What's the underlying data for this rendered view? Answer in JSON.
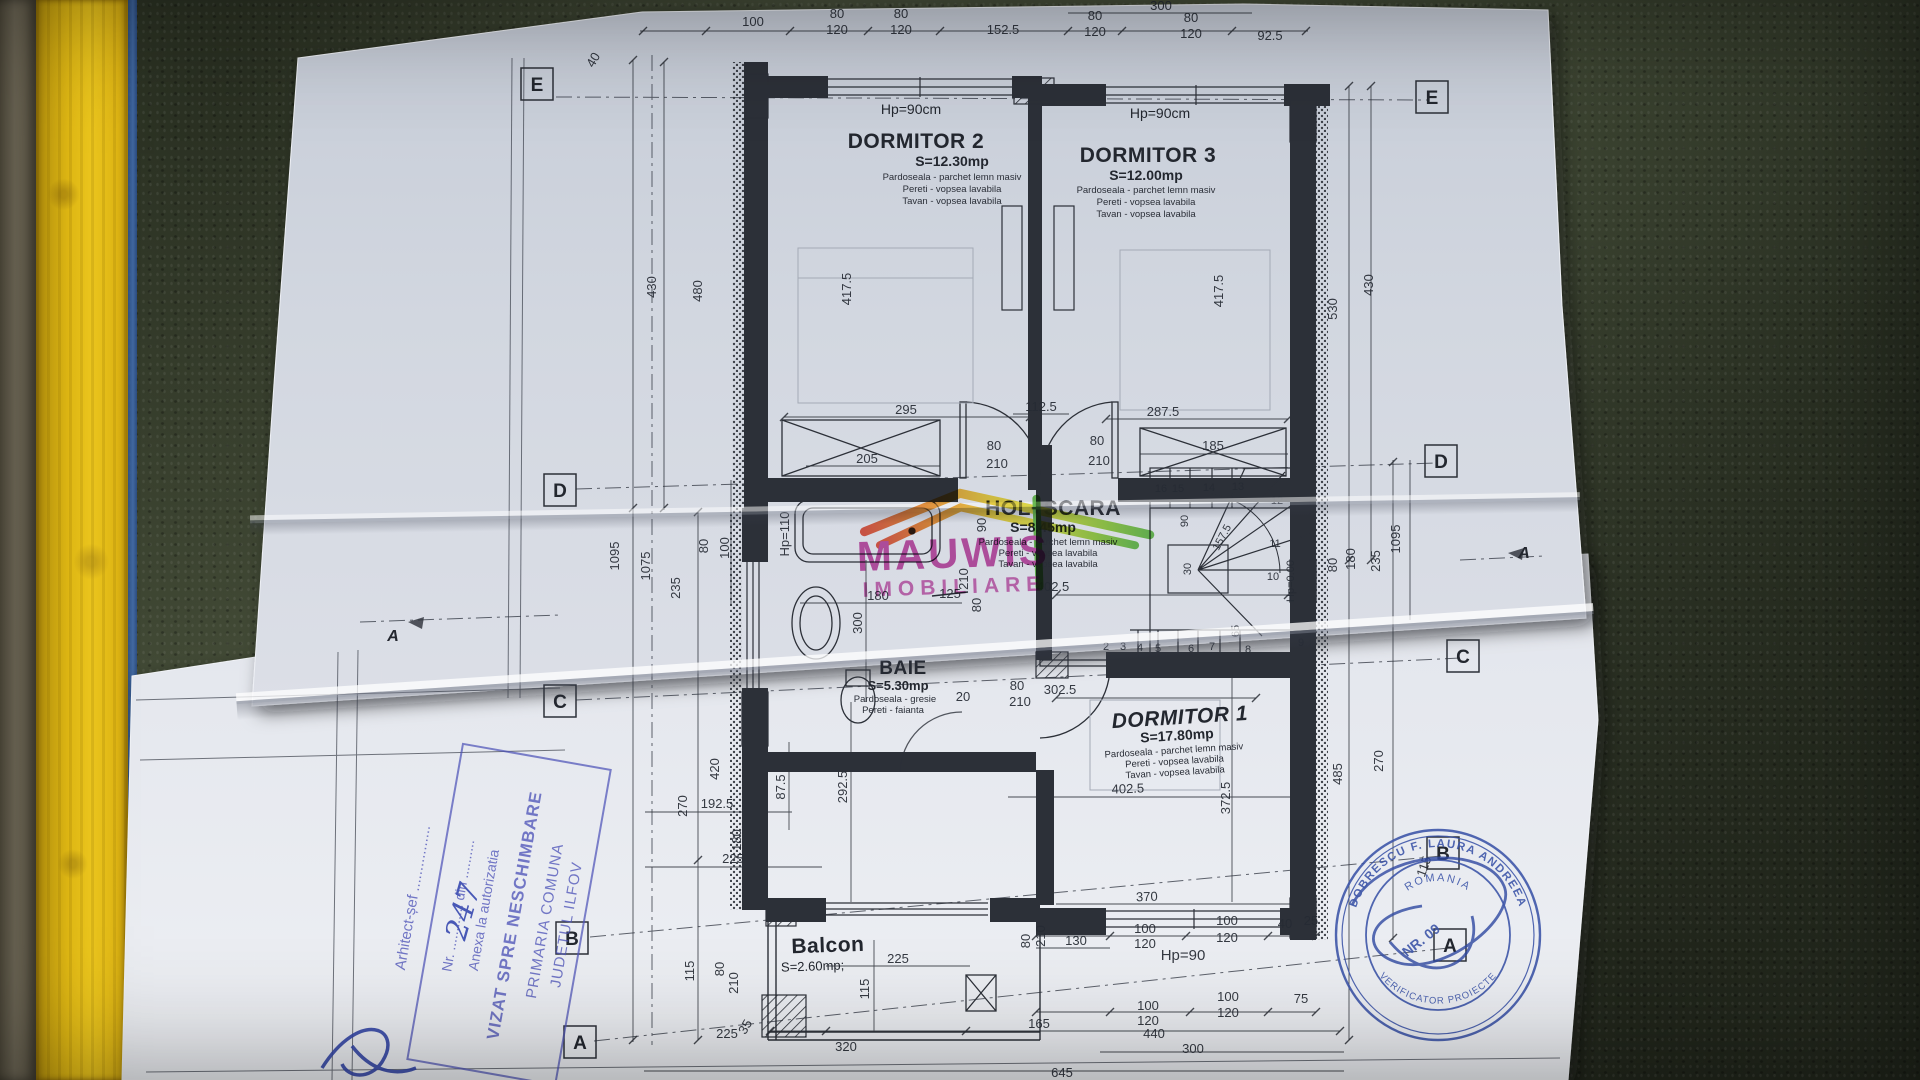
{
  "scene": {
    "background": "#47503a",
    "yellow_frame": "#ecc215",
    "paper": "#d3d8e1",
    "ink": "#262b34",
    "stamp_blue": "#4d53b8",
    "watermark_magenta": "#c23a9e"
  },
  "plan": {
    "hp": {
      "d2": "Hp=90cm",
      "d3": "Hp=90cm"
    },
    "rooms": {
      "d2": {
        "name": "DORMITOR 2",
        "area": "S=12.30mp",
        "m1": "Pardoseala - parchet lemn masiv",
        "m2": "Pereti - vopsea lavabila",
        "m3": "Tavan - vopsea lavabila"
      },
      "d3": {
        "name": "DORMITOR 3",
        "area": "S=12.00mp",
        "m1": "Pardoseala - parchet lemn masiv",
        "m2": "Pereti - vopsea lavabila",
        "m3": "Tavan - vopsea lavabila"
      },
      "hol": {
        "name": "HOL+SCARA",
        "area": "S=8.45mp",
        "m1": "Pardoseala - parchet lemn masiv",
        "m2": "Pereti - vopsea lavabila",
        "m3": "Tavan - vopsea lavabila"
      },
      "baie": {
        "name": "BAIE",
        "area": "S=5.30mp",
        "m1": "Pardoseala - gresie",
        "m2": "Pereti - faianta"
      },
      "d1": {
        "name": "DORMITOR 1",
        "area": "S=17.80mp",
        "m1": "Pardoseala - parchet lemn masiv",
        "m2": "Pereti - vopsea lavabila",
        "m3": "Tavan - vopsea lavabila"
      },
      "balcon": {
        "name": "Balcon",
        "area": "S=2.60mp;"
      }
    },
    "grid": [
      {
        "t": "E",
        "x": 537,
        "y": 84
      },
      {
        "t": "E",
        "x": 1432,
        "y": 97
      },
      {
        "t": "D",
        "x": 560,
        "y": 490
      },
      {
        "t": "D",
        "x": 1441,
        "y": 461
      },
      {
        "t": "C",
        "x": 560,
        "y": 701
      },
      {
        "t": "C",
        "x": 1463,
        "y": 656
      },
      {
        "t": "B",
        "x": 572,
        "y": 938
      },
      {
        "t": "B",
        "x": 1443,
        "y": 853
      },
      {
        "t": "A",
        "x": 580,
        "y": 1042
      },
      {
        "t": "A",
        "x": 1450,
        "y": 945
      },
      {
        "t": "A",
        "x": 393,
        "y": 634,
        "plain": true
      },
      {
        "t": "A",
        "x": 1524,
        "y": 551,
        "plain": true
      }
    ],
    "dims": [
      {
        "t": "100",
        "x": 753,
        "y": 26
      },
      {
        "t": "80",
        "x": 837,
        "y": 18
      },
      {
        "t": "120",
        "x": 837,
        "y": 34
      },
      {
        "t": "80",
        "x": 901,
        "y": 18
      },
      {
        "t": "120",
        "x": 901,
        "y": 34
      },
      {
        "t": "152.5",
        "x": 1003,
        "y": 34
      },
      {
        "t": "80",
        "x": 1095,
        "y": 20
      },
      {
        "t": "120",
        "x": 1095,
        "y": 36
      },
      {
        "t": "300",
        "x": 1161,
        "y": 10
      },
      {
        "t": "80",
        "x": 1191,
        "y": 22
      },
      {
        "t": "120",
        "x": 1191,
        "y": 38
      },
      {
        "t": "92.5",
        "x": 1270,
        "y": 40
      },
      {
        "t": "40",
        "x": 597,
        "y": 62,
        "r": -60
      },
      {
        "t": "430",
        "x": 656,
        "y": 287,
        "r": -90
      },
      {
        "t": "480",
        "x": 702,
        "y": 291,
        "r": -90
      },
      {
        "t": "417.5",
        "x": 851,
        "y": 289,
        "r": -90
      },
      {
        "t": "1095",
        "x": 619,
        "y": 556,
        "r": -90
      },
      {
        "t": "1075",
        "x": 650,
        "y": 566,
        "r": -90
      },
      {
        "t": "235",
        "x": 680,
        "y": 588,
        "r": -90
      },
      {
        "t": "80",
        "x": 708,
        "y": 546,
        "r": -90
      },
      {
        "t": "100",
        "x": 729,
        "y": 548,
        "r": -90
      },
      {
        "t": "Hp=110",
        "x": 789,
        "y": 534,
        "r": -90
      },
      {
        "t": "420",
        "x": 719,
        "y": 769,
        "r": -90
      },
      {
        "t": "270",
        "x": 687,
        "y": 806,
        "r": -90
      },
      {
        "t": "115",
        "x": 694,
        "y": 971,
        "r": -90
      },
      {
        "t": "80",
        "x": 724,
        "y": 969,
        "r": -90
      },
      {
        "t": "210",
        "x": 738,
        "y": 983,
        "r": -90
      },
      {
        "t": "35",
        "x": 749,
        "y": 1029,
        "r": -60
      },
      {
        "t": "300",
        "x": 862,
        "y": 623,
        "r": -90
      },
      {
        "t": "87.5",
        "x": 785,
        "y": 787,
        "r": -90
      },
      {
        "t": "292.5",
        "x": 847,
        "y": 787,
        "r": -90
      },
      {
        "t": "192.5",
        "x": 717,
        "y": 808
      },
      {
        "t": "180",
        "x": 741,
        "y": 840,
        "r": -90
      },
      {
        "t": "225",
        "x": 733,
        "y": 863
      },
      {
        "t": "530",
        "x": 1337,
        "y": 309,
        "r": -90
      },
      {
        "t": "430",
        "x": 1373,
        "y": 285,
        "r": -90
      },
      {
        "t": "417.5",
        "x": 1223,
        "y": 291,
        "r": -90
      },
      {
        "t": "1095",
        "x": 1400,
        "y": 539,
        "r": -90
      },
      {
        "t": "235",
        "x": 1380,
        "y": 561,
        "r": -90
      },
      {
        "t": "180",
        "x": 1355,
        "y": 559,
        "r": -90
      },
      {
        "t": "80",
        "x": 1337,
        "y": 565,
        "r": -90
      },
      {
        "t": "270",
        "x": 1383,
        "y": 761,
        "r": -90
      },
      {
        "t": "485",
        "x": 1342,
        "y": 774,
        "r": -90
      },
      {
        "t": "372.5",
        "x": 1230,
        "y": 798,
        "r": -90
      },
      {
        "t": "115",
        "x": 1428,
        "y": 868,
        "r": -70
      },
      {
        "t": "295",
        "x": 906,
        "y": 414
      },
      {
        "t": "287.5",
        "x": 1163,
        "y": 416
      },
      {
        "t": "205",
        "x": 867,
        "y": 463
      },
      {
        "t": "185",
        "x": 1213,
        "y": 450
      },
      {
        "t": "112.5",
        "x": 1041,
        "y": 411
      },
      {
        "t": "80",
        "x": 994,
        "y": 450
      },
      {
        "t": "210",
        "x": 997,
        "y": 468
      },
      {
        "t": "80",
        "x": 1097,
        "y": 445
      },
      {
        "t": "210",
        "x": 1099,
        "y": 465
      },
      {
        "t": "125",
        "x": 950,
        "y": 598,
        "strike": true
      },
      {
        "t": "90",
        "x": 986,
        "y": 525,
        "r": -90
      },
      {
        "t": "210",
        "x": 968,
        "y": 579,
        "r": -90
      },
      {
        "t": "80",
        "x": 981,
        "y": 605,
        "r": -90
      },
      {
        "t": "180",
        "x": 878,
        "y": 600
      },
      {
        "t": "402.5",
        "x": 1053,
        "y": 591
      },
      {
        "t": "302.5",
        "x": 1060,
        "y": 694
      },
      {
        "t": "20",
        "x": 963,
        "y": 701
      },
      {
        "t": "80",
        "x": 1017,
        "y": 690
      },
      {
        "t": "210",
        "x": 1020,
        "y": 706
      },
      {
        "t": "402.5",
        "x": 1128,
        "y": 793,
        "r": -2
      },
      {
        "t": "370",
        "x": 1147,
        "y": 901,
        "r": -2
      },
      {
        "t": "130",
        "x": 1076,
        "y": 945
      },
      {
        "t": "100",
        "x": 1145,
        "y": 933
      },
      {
        "t": "120",
        "x": 1145,
        "y": 948
      },
      {
        "t": "100",
        "x": 1227,
        "y": 925
      },
      {
        "t": "120",
        "x": 1227,
        "y": 942
      },
      {
        "t": "40",
        "x": 1285,
        "y": 928
      },
      {
        "t": "25",
        "x": 1311,
        "y": 925
      },
      {
        "t": "Hp=90",
        "x": 1183,
        "y": 960,
        "s": 15
      },
      {
        "t": "100",
        "x": 1148,
        "y": 1010
      },
      {
        "t": "120",
        "x": 1148,
        "y": 1025
      },
      {
        "t": "100",
        "x": 1228,
        "y": 1001
      },
      {
        "t": "120",
        "x": 1228,
        "y": 1017
      },
      {
        "t": "75",
        "x": 1301,
        "y": 1003
      },
      {
        "t": "165",
        "x": 1039,
        "y": 1028
      },
      {
        "t": "440",
        "x": 1154,
        "y": 1038
      },
      {
        "t": "300",
        "x": 1193,
        "y": 1053
      },
      {
        "t": "645",
        "x": 1062,
        "y": 1077
      },
      {
        "t": "80",
        "x": 1030,
        "y": 941,
        "r": -90
      },
      {
        "t": "210",
        "x": 1045,
        "y": 936,
        "r": -90
      },
      {
        "t": "225",
        "x": 898,
        "y": 963
      },
      {
        "t": "115",
        "x": 869,
        "y": 989,
        "r": -90
      },
      {
        "t": "225",
        "x": 727,
        "y": 1038
      },
      {
        "t": "320",
        "x": 846,
        "y": 1051
      },
      {
        "t": "90",
        "x": 1188,
        "y": 521,
        "r": -90,
        "s": 11
      },
      {
        "t": "30",
        "x": 1191,
        "y": 569,
        "r": -90,
        "s": 11
      },
      {
        "t": "157.5",
        "x": 1225,
        "y": 539,
        "r": -62,
        "s": 11
      },
      {
        "t": "65",
        "x": 1239,
        "y": 631,
        "r": -90,
        "s": 11
      },
      {
        "t": "Hp=0.00",
        "x": 1294,
        "y": 581,
        "r": -90,
        "s": 11
      },
      {
        "t": "16",
        "x": 1161,
        "y": 492,
        "s": 11
      },
      {
        "t": "15",
        "x": 1178,
        "y": 492,
        "s": 11
      },
      {
        "t": "14",
        "x": 1209,
        "y": 491,
        "s": 11
      },
      {
        "t": "13",
        "x": 1238,
        "y": 490,
        "s": 11
      },
      {
        "t": "12",
        "x": 1277,
        "y": 504,
        "s": 11
      },
      {
        "t": "11",
        "x": 1275,
        "y": 547,
        "s": 11
      },
      {
        "t": "10",
        "x": 1273,
        "y": 580,
        "s": 11
      },
      {
        "t": "9",
        "x": 1301,
        "y": 646,
        "s": 11
      },
      {
        "t": "8",
        "x": 1248,
        "y": 653,
        "s": 11
      },
      {
        "t": "7",
        "x": 1212,
        "y": 650,
        "s": 11
      },
      {
        "t": "6",
        "x": 1191,
        "y": 652,
        "s": 11
      },
      {
        "t": "5",
        "x": 1158,
        "y": 652,
        "s": 11
      },
      {
        "t": "4",
        "x": 1140,
        "y": 651,
        "s": 11
      },
      {
        "t": "3",
        "x": 1123,
        "y": 650,
        "s": 11
      },
      {
        "t": "2",
        "x": 1106,
        "y": 650,
        "s": 11
      }
    ]
  },
  "watermark": {
    "line1": "MAUWIS",
    "line2": "IMOBILIARE"
  },
  "stamps": {
    "approval": {
      "line1": "JUDETUL ILFOV",
      "line2": "PRIMARIA COMUNA",
      "line3": "VIZAT SPRE NESCHIMBARE",
      "line4": "Anexa la autorizatia",
      "line5": "Nr. ............ din ..........",
      "handwritten": "247",
      "arhitect": "Arhitect-șef ................"
    },
    "round": {
      "arc_top": "DOBRESCU F. LAURA ANDREEA",
      "inner": "ROMANIA",
      "center": "NR. 09",
      "arc_bottom": "VERIFICATOR PROIECTE"
    }
  }
}
